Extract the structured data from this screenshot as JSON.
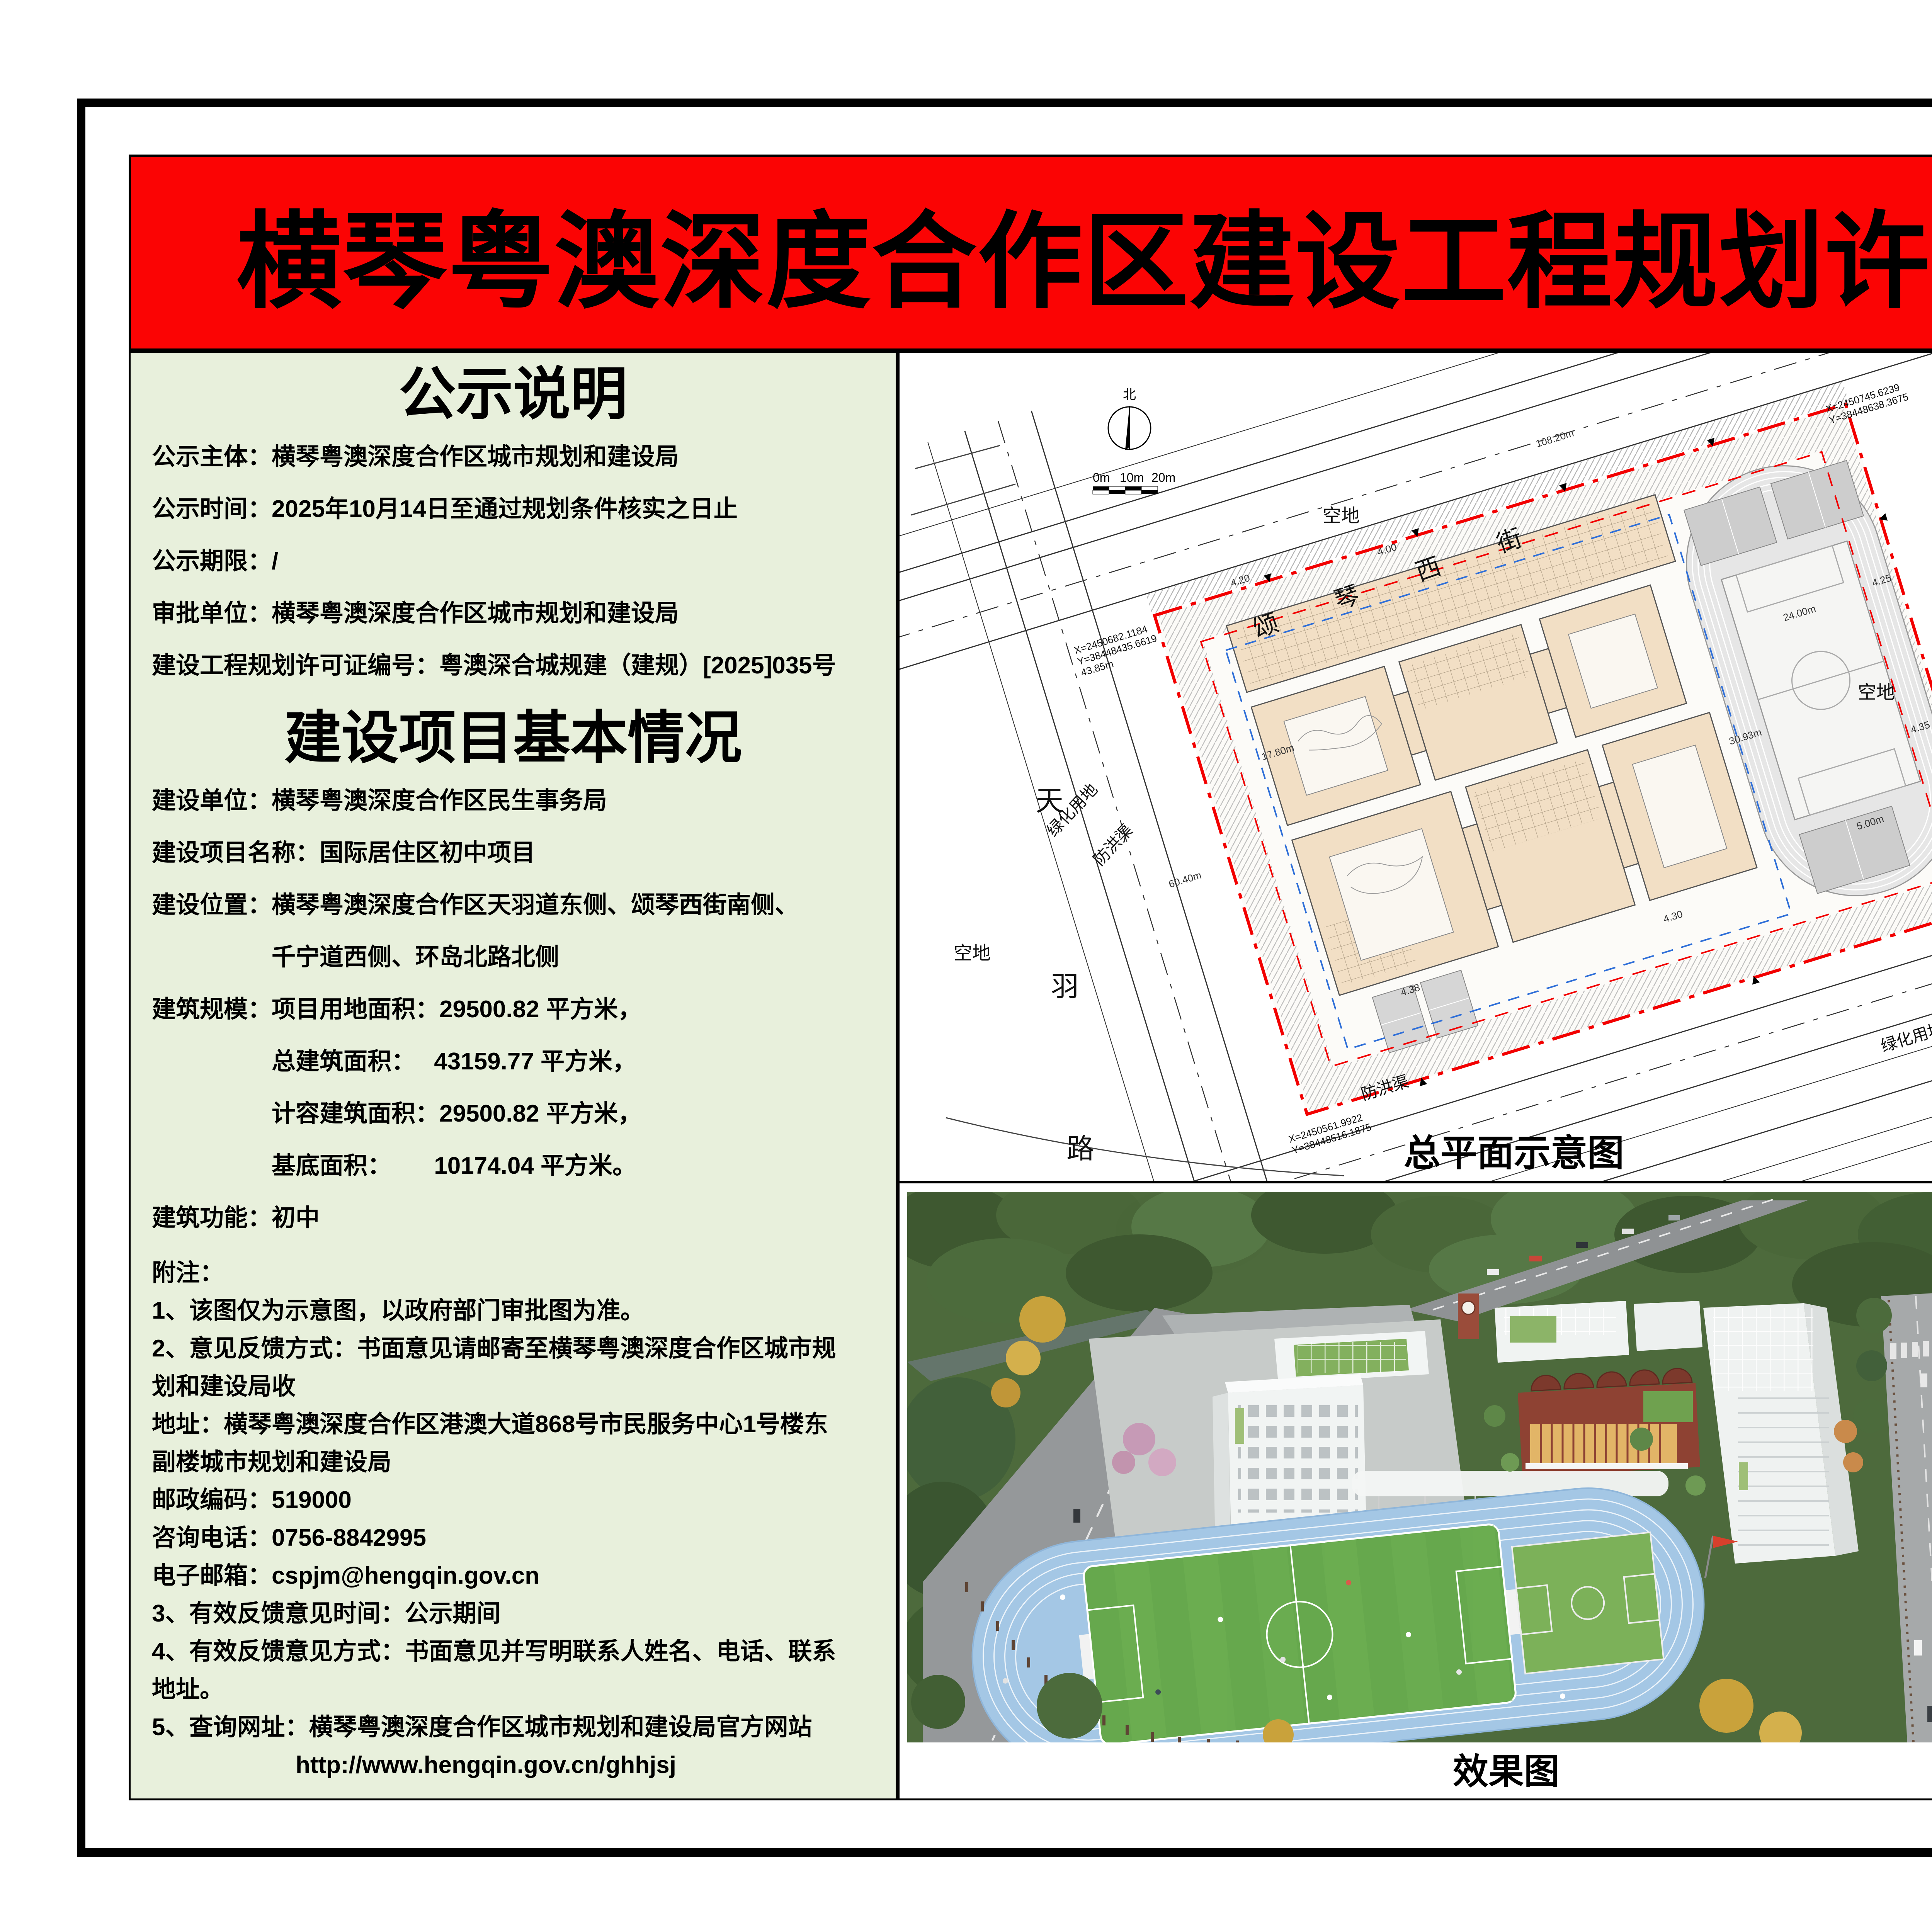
{
  "banner": {
    "title": "横琴粤澳深度合作区建设工程规划许可批后公告"
  },
  "notice": {
    "heading": "公示说明",
    "lines": [
      "公示主体：横琴粤澳深度合作区城市规划和建设局",
      "公示时间：2025年10月14日至通过规划条件核实之日止",
      "公示期限：/",
      "审批单位：横琴粤澳深度合作区城市规划和建设局",
      "建设工程规划许可证编号：粤澳深合城规建（建规）[2025]035号"
    ]
  },
  "project": {
    "heading": "建设项目基本情况",
    "lines": [
      "建设单位：横琴粤澳深度合作区民生事务局",
      "建设项目名称：国际居住区初中项目",
      "建设位置：横琴粤澳深度合作区天羽道东侧、颂琴西街南侧、",
      "　　　　　千宁道西侧、环岛北路北侧",
      "建筑规模：项目用地面积：29500.82 平方米，",
      "　　　　　总建筑面积：　 43159.77 平方米，",
      "　　　　　计容建筑面积：29500.82 平方米，",
      "　　　　　基底面积：　　 10174.04 平方米。",
      "建筑功能：初中"
    ]
  },
  "notes": {
    "lines": [
      "附注：",
      "1、该图仅为示意图，以政府部门审批图为准。",
      "2、意见反馈方式：书面意见请邮寄至横琴粤澳深度合作区城市规",
      "划和建设局收",
      "地址：横琴粤澳深度合作区港澳大道868号市民服务中心1号楼东",
      "副楼城市规划和建设局",
      "邮政编码：519000",
      "咨询电话：0756-8842995",
      "电子邮箱：cspjm@hengqin.gov.cn",
      "3、有效反馈意见时间：公示期间",
      "4、有效反馈意见方式：书面意见并写明联系人姓名、电话、联系",
      "地址。",
      "5、查询网址：横琴粤澳深度合作区城市规划和建设局官方网站",
      "　　　　　　http://www.hengqin.gov.cn/ghhjsj"
    ]
  },
  "site_plan": {
    "caption": "总平面示意图",
    "north_label": "北",
    "scale_labels": [
      "0m",
      "10m",
      "20m"
    ],
    "street_chars": [
      "颂",
      "琴",
      "西",
      "街"
    ],
    "road_chars": [
      "天",
      "羽",
      "路"
    ],
    "labels": {
      "kongdi": "空地",
      "lvhua": "绿化用地",
      "fanghongqu": "防洪渠"
    },
    "coords": [
      "X=2450682.1184",
      "Y=38448435.6619",
      "43.85m",
      "X=2450745.6239",
      "Y=38448638.3675",
      "X=2450606.2860",
      "Y=38448657.3894",
      "X=2450561.9922",
      "Y=38448516.1875"
    ],
    "dims": [
      "108.20m",
      "24.00m",
      "30.93m",
      "4.00",
      "4.20",
      "4.25",
      "4.35",
      "4.30",
      "4.38",
      "5.00m",
      "17.80m",
      "60.40m"
    ],
    "legend": {
      "title": "图　例:",
      "items": [
        {
          "label": "规划地上建筑主体:",
          "type": "building",
          "color": "#F2DFC5"
        },
        {
          "label": "规划用地红线:",
          "type": "red-dashdot",
          "color": "#FF0000"
        },
        {
          "label": "规划建筑控制线",
          "type": "red-dash",
          "color": "#FF0000"
        },
        {
          "label": "地下室边线",
          "type": "blue-dash",
          "color": "#2F7BD6"
        },
        {
          "label": "规划道路边线:",
          "type": "road-edge",
          "color": "#444444"
        },
        {
          "label": "规划道路中心线:",
          "type": "road-center",
          "color": "#555555"
        }
      ]
    }
  },
  "render_view": {
    "caption": "效果图"
  },
  "colors": {
    "banner_red": "#FB0404",
    "panel_green": "#E8F0DC",
    "building_tan": "#F2DFC5",
    "red_line": "#FF0000",
    "blue_line": "#2F7BD6",
    "track_blue": "#A4C7E5",
    "field_green": "#66A84D"
  }
}
